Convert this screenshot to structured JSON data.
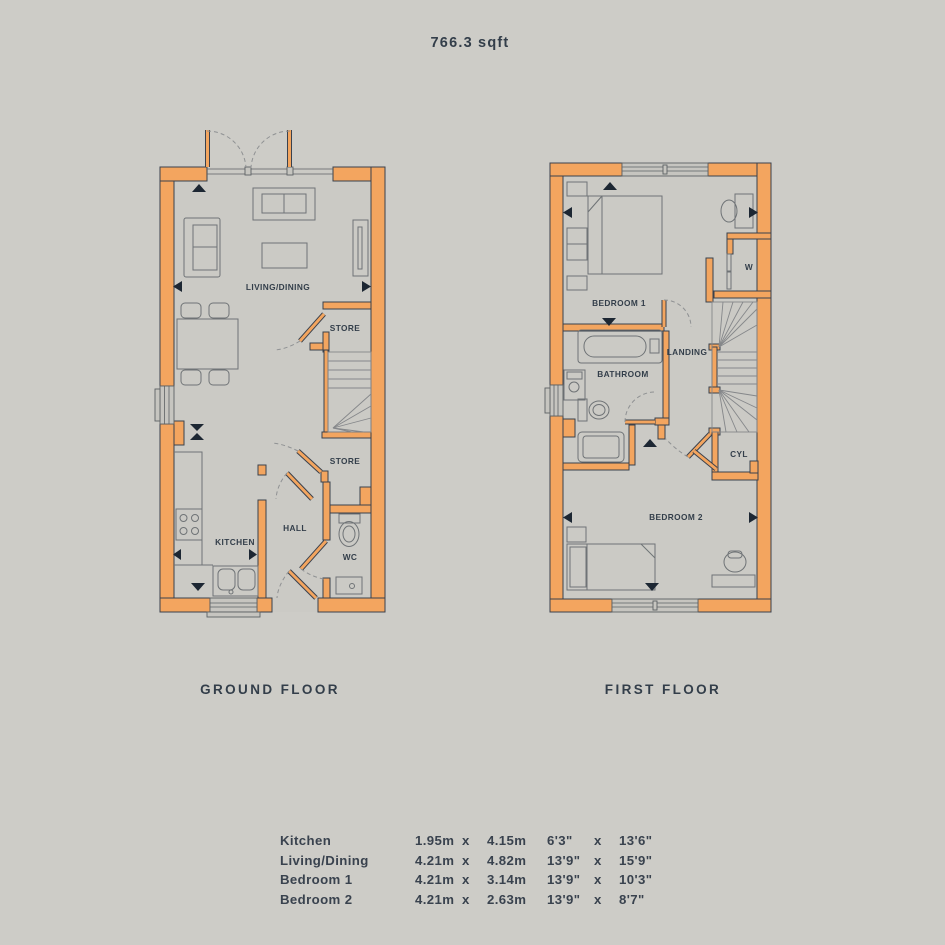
{
  "title": "766.3 sqft",
  "colors": {
    "background": "#cdccc7",
    "wall_fill": "#f3a55f",
    "outline": "#3a414d",
    "text": "#333e4a",
    "floor_fill": "#cbcac5"
  },
  "ground_floor": {
    "name": "GROUND FLOOR",
    "rooms": {
      "living_dining": "LIVING/DINING",
      "store_upper": "STORE",
      "store_lower": "STORE",
      "hall": "HALL",
      "kitchen": "KITCHEN",
      "wc": "WC"
    }
  },
  "first_floor": {
    "name": "FIRST FLOOR",
    "rooms": {
      "bedroom1": "BEDROOM 1",
      "wardrobe": "W",
      "landing": "LANDING",
      "bathroom": "BATHROOM",
      "cylinder": "CYL",
      "bedroom2": "BEDROOM 2"
    }
  },
  "dimensions_table": {
    "separator": "x",
    "rows": [
      {
        "name": "Kitchen",
        "metric_w": "1.95m",
        "metric_h": "4.15m",
        "imperial_w": "6'3\"",
        "imperial_h": "13'6\""
      },
      {
        "name": "Living/Dining",
        "metric_w": "4.21m",
        "metric_h": "4.82m",
        "imperial_w": "13'9\"",
        "imperial_h": "15'9\""
      },
      {
        "name": "Bedroom 1",
        "metric_w": "4.21m",
        "metric_h": "3.14m",
        "imperial_w": "13'9\"",
        "imperial_h": "10'3\""
      },
      {
        "name": "Bedroom 2",
        "metric_w": "4.21m",
        "metric_h": "2.63m",
        "imperial_w": "13'9\"",
        "imperial_h": "8'7\""
      }
    ]
  }
}
